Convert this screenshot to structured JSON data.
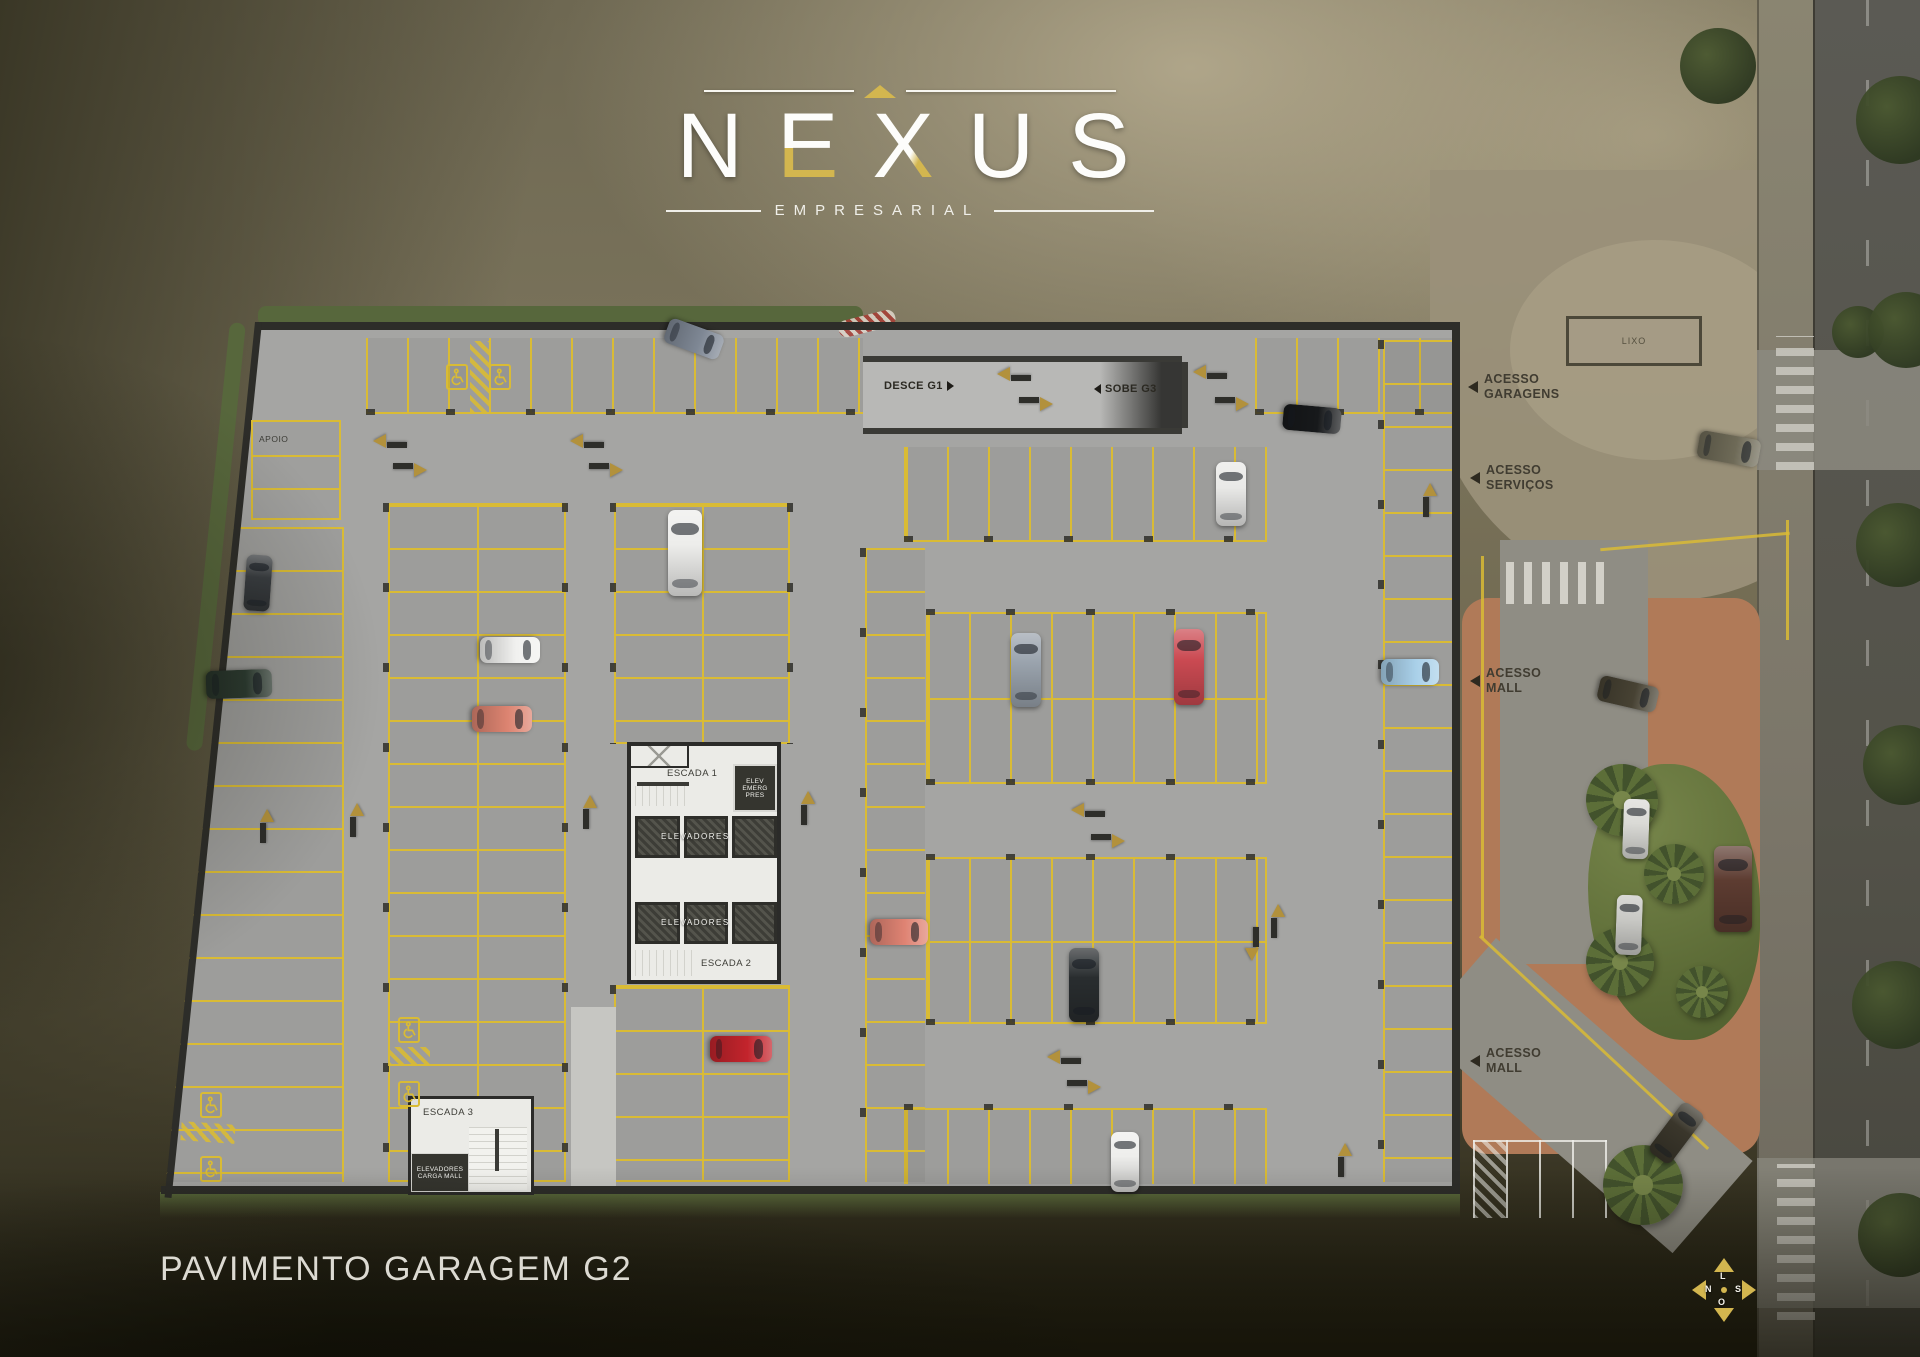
{
  "logo": {
    "name": "NEXUS",
    "subtitle": "EMPRESARIAL"
  },
  "title": "PAVIMENTO GARAGEM G2",
  "colors": {
    "gold": "#d3b64f",
    "lineYellow": "#d9bb35",
    "arrow": "#b2913c",
    "floor": "#a5a5a3",
    "terracotta": "#b07a58",
    "grass": "#66753c",
    "road": "#55544e"
  },
  "ramp": {
    "down_label": "DESCE G1",
    "up_label": "SOBE G3"
  },
  "rooms": {
    "apoio": "APOIO",
    "lixo": "LIXO",
    "escada1": "ESCADA 1",
    "escada2": "ESCADA 2",
    "escada3": "ESCADA 3",
    "elevators_label": "ELEVADORES",
    "elev_emerg": [
      "ELEV",
      "EMERG",
      "PRES"
    ],
    "carga": [
      "ELEVADORES",
      "CARGA MALL"
    ]
  },
  "access": {
    "garagens": [
      "ACESSO",
      "GARAGENS"
    ],
    "servicos": [
      "ACESSO",
      "SERVIÇOS"
    ],
    "mall": [
      "ACESSO",
      "MALL"
    ]
  },
  "compass": {
    "top": "L",
    "left": "N",
    "right": "S",
    "bottom": "O"
  },
  "plan": {
    "cars": [
      {
        "cx": 694,
        "cy": 339,
        "len": 58,
        "wid": 26,
        "rot": 110,
        "color": "#7e8794"
      },
      {
        "cx": 1312,
        "cy": 419,
        "len": 58,
        "wid": 26,
        "rot": 95,
        "color": "#17191b"
      },
      {
        "cx": 1231,
        "cy": 494,
        "len": 64,
        "wid": 30,
        "rot": 0,
        "color": "#e9e9e7"
      },
      {
        "cx": 239,
        "cy": 684,
        "len": 66,
        "wid": 28,
        "rot": 88,
        "color": "#2c3b31"
      },
      {
        "cx": 258,
        "cy": 583,
        "len": 56,
        "wid": 26,
        "rot": 4,
        "color": "#393d41"
      },
      {
        "cx": 510,
        "cy": 650,
        "len": 60,
        "wid": 26,
        "rot": 90,
        "color": "#f1f1ef"
      },
      {
        "cx": 502,
        "cy": 719,
        "len": 60,
        "wid": 26,
        "rot": 90,
        "color": "#dd8471"
      },
      {
        "cx": 685,
        "cy": 553,
        "len": 86,
        "wid": 34,
        "rot": 0,
        "color": "#ededeb"
      },
      {
        "cx": 741,
        "cy": 1049,
        "len": 62,
        "wid": 26,
        "rot": 90,
        "color": "#c3242c"
      },
      {
        "cx": 1026,
        "cy": 670,
        "len": 74,
        "wid": 30,
        "rot": 0,
        "color": "#9aa3ad"
      },
      {
        "cx": 1189,
        "cy": 667,
        "len": 76,
        "wid": 30,
        "rot": 0,
        "color": "#cb4a52"
      },
      {
        "cx": 899,
        "cy": 932,
        "len": 58,
        "wid": 26,
        "rot": 90,
        "color": "#df8373"
      },
      {
        "cx": 1084,
        "cy": 985,
        "len": 74,
        "wid": 30,
        "rot": 0,
        "color": "#292d2f"
      },
      {
        "cx": 1125,
        "cy": 1162,
        "len": 60,
        "wid": 28,
        "rot": 0,
        "color": "#eeeeec"
      },
      {
        "cx": 1410,
        "cy": 672,
        "len": 58,
        "wid": 26,
        "rot": 90,
        "color": "#a9d0e9"
      },
      {
        "cx": 1729,
        "cy": 449,
        "len": 62,
        "wid": 28,
        "rot": 100,
        "color": "#6e6a57"
      },
      {
        "cx": 1628,
        "cy": 694,
        "len": 60,
        "wid": 26,
        "rot": 103,
        "color": "#474233"
      },
      {
        "cx": 1636,
        "cy": 829,
        "len": 60,
        "wid": 26,
        "rot": 2,
        "color": "#dadad6"
      },
      {
        "cx": 1629,
        "cy": 925,
        "len": 60,
        "wid": 26,
        "rot": 2,
        "color": "#c9c9c5"
      },
      {
        "cx": 1733,
        "cy": 889,
        "len": 86,
        "wid": 38,
        "rot": 0,
        "color": "#5d3c31"
      },
      {
        "cx": 1676,
        "cy": 1133,
        "len": 62,
        "wid": 27,
        "rot": 37,
        "color": "#3a362b"
      }
    ],
    "arrows": [
      {
        "dir": "left",
        "x": 390,
        "y": 441
      },
      {
        "dir": "right",
        "x": 410,
        "y": 470
      },
      {
        "dir": "left",
        "x": 587,
        "y": 441
      },
      {
        "dir": "right",
        "x": 606,
        "y": 470
      },
      {
        "dir": "left",
        "x": 1014,
        "y": 374
      },
      {
        "dir": "right",
        "x": 1036,
        "y": 404
      },
      {
        "dir": "left",
        "x": 1210,
        "y": 372
      },
      {
        "dir": "right",
        "x": 1232,
        "y": 404
      },
      {
        "dir": "up",
        "x": 267,
        "y": 826
      },
      {
        "dir": "up",
        "x": 357,
        "y": 820
      },
      {
        "dir": "up",
        "x": 590,
        "y": 812
      },
      {
        "dir": "up",
        "x": 808,
        "y": 808
      },
      {
        "dir": "left",
        "x": 1088,
        "y": 810
      },
      {
        "dir": "right",
        "x": 1108,
        "y": 841
      },
      {
        "dir": "left",
        "x": 1064,
        "y": 1057
      },
      {
        "dir": "right",
        "x": 1084,
        "y": 1087
      },
      {
        "dir": "down",
        "x": 1252,
        "y": 944
      },
      {
        "dir": "up",
        "x": 1278,
        "y": 921
      },
      {
        "dir": "up",
        "x": 1345,
        "y": 1160
      },
      {
        "dir": "up",
        "x": 1430,
        "y": 500
      }
    ],
    "handicap_spots": [
      {
        "x": 457,
        "y": 377
      },
      {
        "x": 500,
        "y": 377
      },
      {
        "x": 409,
        "y": 1030
      },
      {
        "x": 409,
        "y": 1094
      },
      {
        "x": 211,
        "y": 1105
      },
      {
        "x": 211,
        "y": 1169
      }
    ],
    "vegetation": [
      {
        "type": "palm",
        "x": 1622,
        "y": 800,
        "r": 36
      },
      {
        "type": "palm",
        "x": 1674,
        "y": 874,
        "r": 30
      },
      {
        "type": "palm",
        "x": 1620,
        "y": 962,
        "r": 34
      },
      {
        "type": "palm",
        "x": 1702,
        "y": 992,
        "r": 26
      },
      {
        "type": "palm",
        "x": 1643,
        "y": 1185,
        "r": 40
      },
      {
        "type": "tree",
        "x": 1718,
        "y": 66,
        "r": 38
      },
      {
        "type": "tree",
        "x": 1858,
        "y": 332,
        "r": 26
      },
      {
        "type": "tree",
        "x": 1900,
        "y": 120,
        "r": 44
      },
      {
        "type": "tree",
        "x": 1906,
        "y": 330,
        "r": 38
      },
      {
        "type": "tree",
        "x": 1898,
        "y": 545,
        "r": 42
      },
      {
        "type": "tree",
        "x": 1903,
        "y": 765,
        "r": 40
      },
      {
        "type": "tree",
        "x": 1896,
        "y": 1005,
        "r": 44
      },
      {
        "type": "tree",
        "x": 1900,
        "y": 1235,
        "r": 42
      }
    ]
  }
}
